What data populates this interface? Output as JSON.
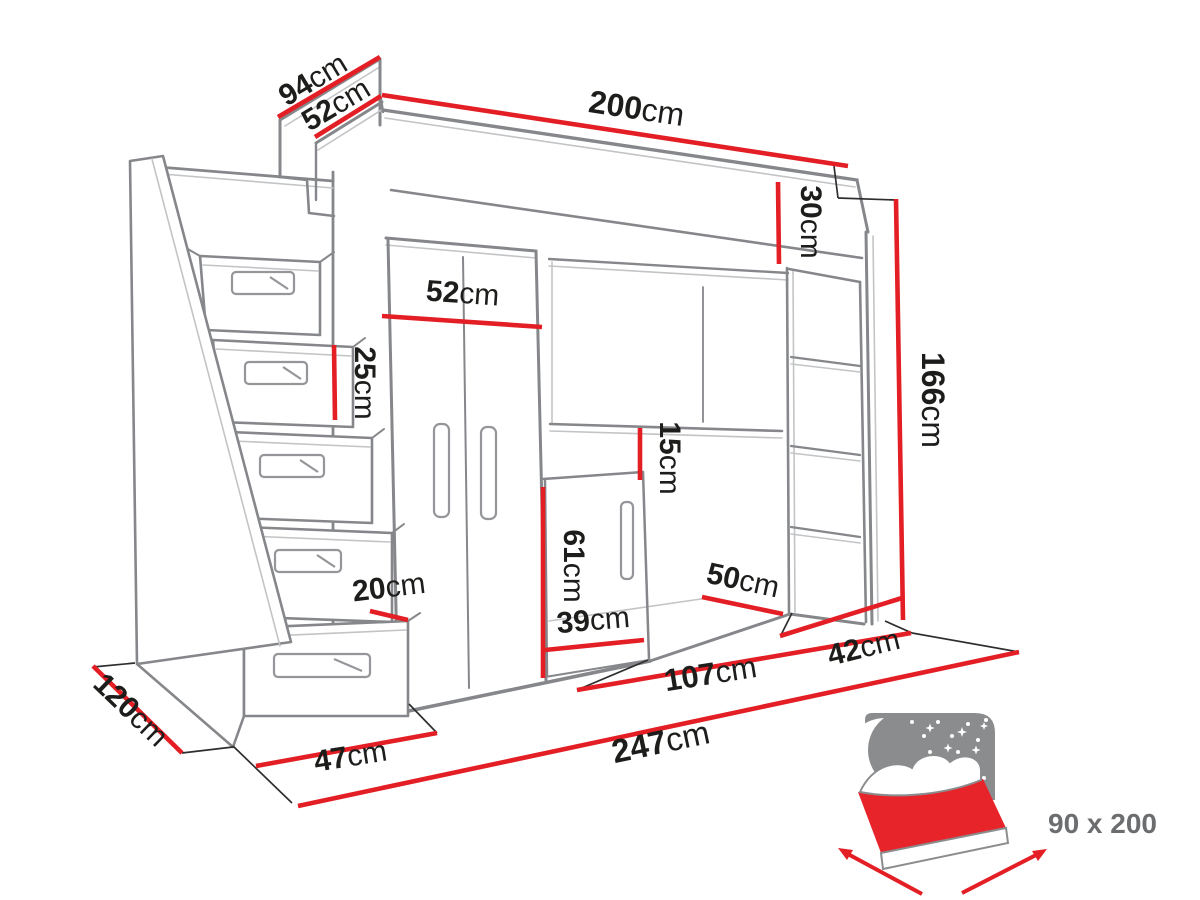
{
  "figure": {
    "kind": "furniture-dimension-diagram",
    "item": "loft bed unit with drawer staircase, wardrobe, desk niche, cabinet and open shelving"
  },
  "colors": {
    "dimension_red": "#e31e24",
    "sketch_gray": "#85878a",
    "label_black": "#1d1d1b",
    "bed_icon_gray": "#8a8c8e",
    "mattress_red": "#e8242b"
  },
  "dimensions": {
    "top_depth": {
      "value": "94",
      "unit": "cm"
    },
    "top_section": {
      "value": "52",
      "unit": "cm"
    },
    "bed_length": {
      "value": "200",
      "unit": "cm"
    },
    "fascia_height": {
      "value": "30",
      "unit": "cm"
    },
    "unit_height": {
      "value": "166",
      "unit": "cm"
    },
    "wardrobe_width": {
      "value": "52",
      "unit": "cm"
    },
    "step_height": {
      "value": "25",
      "unit": "cm"
    },
    "shelf_gap": {
      "value": "15",
      "unit": "cm"
    },
    "cabinet_height": {
      "value": "61",
      "unit": "cm"
    },
    "shelving_width": {
      "value": "50",
      "unit": "cm"
    },
    "cabinet_width": {
      "value": "39",
      "unit": "cm"
    },
    "step_depth": {
      "value": "20",
      "unit": "cm"
    },
    "stairs_depth": {
      "value": "120",
      "unit": "cm"
    },
    "stairs_width": {
      "value": "47",
      "unit": "cm"
    },
    "total_width": {
      "value": "247",
      "unit": "cm"
    },
    "niche_width": {
      "value": "107",
      "unit": "cm"
    },
    "shelving_depth": {
      "value": "42",
      "unit": "cm"
    }
  },
  "bed_icon": {
    "size_label": "90 x 200"
  }
}
